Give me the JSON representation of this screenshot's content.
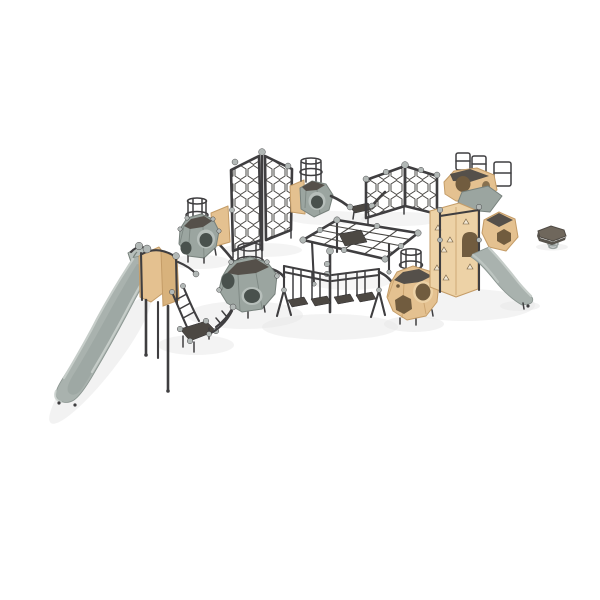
{
  "scene": {
    "title": "Playground climbing structure — 3D product render",
    "type": "3d-product-render",
    "description": "Modular playground climbing set rendered on a plain white background, isometric-style view",
    "background": "#ffffff",
    "visible_text": ""
  },
  "palette": {
    "background": "#ffffff",
    "frame_dark": "#3f3e40",
    "frame_darker": "#2c2b2d",
    "slide_gray": "#a9b2ae",
    "slide_gray_light": "#c6cdc9",
    "slide_gray_dark": "#89948f",
    "pod_gray": "#9ba5a0",
    "pod_gray_light": "#b7bfbb",
    "pod_gray_dark": "#77817c",
    "pod_top_dark": "#55504a",
    "tan": "#e4c190",
    "tan_light": "#edd2a6",
    "tan_dark": "#c49c67",
    "hole_inner_gray": "#49514d",
    "hole_inner_tan": "#715c3f",
    "ball_gray": "#b2b8b6",
    "tread_dark": "#4c4843",
    "rope": "#4a4845",
    "shadow": "#e7e7e7",
    "hold_light": "#f3e8d4",
    "spinner_top": "#6f675c",
    "spinner_rim": "#57534c",
    "spring_gray": "#9aa2a0"
  },
  "components": {
    "large_slide": "large grey slide with sand-coloured entry panels and support posts",
    "access_platform": "dark step platform with ladder up to slide deck and climbing pod",
    "pod_gray_left": "grey polyhedron climbing pod with round openings and top guard rail",
    "pod_gray_center": "large grey polyhedron climbing pod with round openings and hexagonal guard rail",
    "pod_gray_rear": "grey climbing pod with sand panel, guard rail and traverse step",
    "a_frame_net": "A-frame hexagonal rope climbing net",
    "hex_net_wall": "folded hexagonal rope net climbing wall",
    "rope_net": "inclined rope climbing net with centre platform and support posts",
    "step_bridge": "hanging-step balance bridge with double handrails",
    "pod_tan_front": "sand-coloured polyhedron climbing pod with round and hex openings",
    "tower_cluster": "multi-pod sand-coloured climbing tower with guard rails, triangle holds and arch doorway",
    "small_slide": "small grey slide exiting the climbing tower",
    "spinner": "hexagonal spring spinner seat standing apart on the right"
  }
}
